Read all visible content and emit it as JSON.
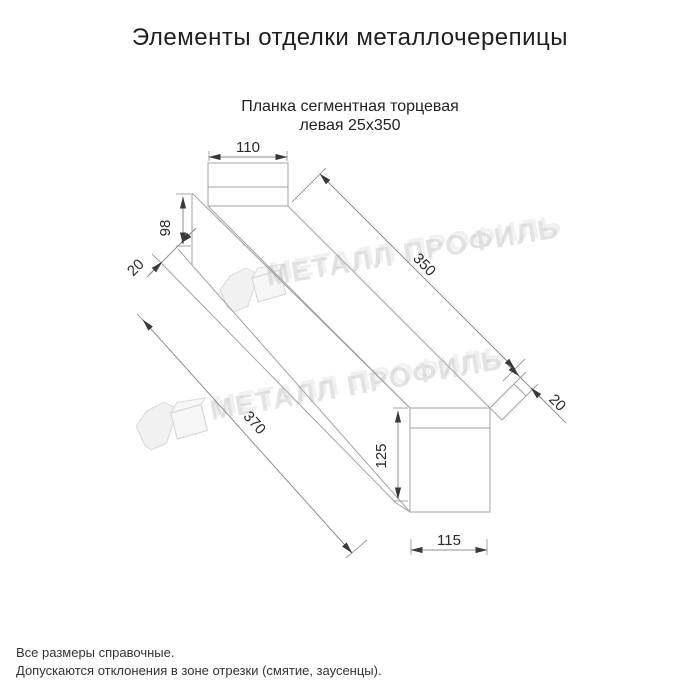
{
  "page": {
    "title": "Элементы отделки металлочерепицы",
    "subtitle_line1": "Планка сегментная торцевая",
    "subtitle_line2": "левая 25х350"
  },
  "drawing": {
    "name": "Планка сегментная торцевая левая — аксонометрия",
    "dimensions": {
      "top_width": "110",
      "front_height": "98",
      "hem_left": "20",
      "length_top": "350",
      "length_bottom": "370",
      "hem_right": "20",
      "end_height": "125",
      "end_width": "115"
    },
    "line_color": "#a3a3a3",
    "arrow_color": "#3a3a3a"
  },
  "watermark": {
    "text": "МЕТАЛЛ ПРОФИЛЬ",
    "logo_name": "metall-profil-logo",
    "color": "#c9c9c9"
  },
  "notes": {
    "line1": "Все размеры справочные.",
    "line2": "Допускаются отклонения в зоне отрезки (смятие, заусенцы)."
  }
}
